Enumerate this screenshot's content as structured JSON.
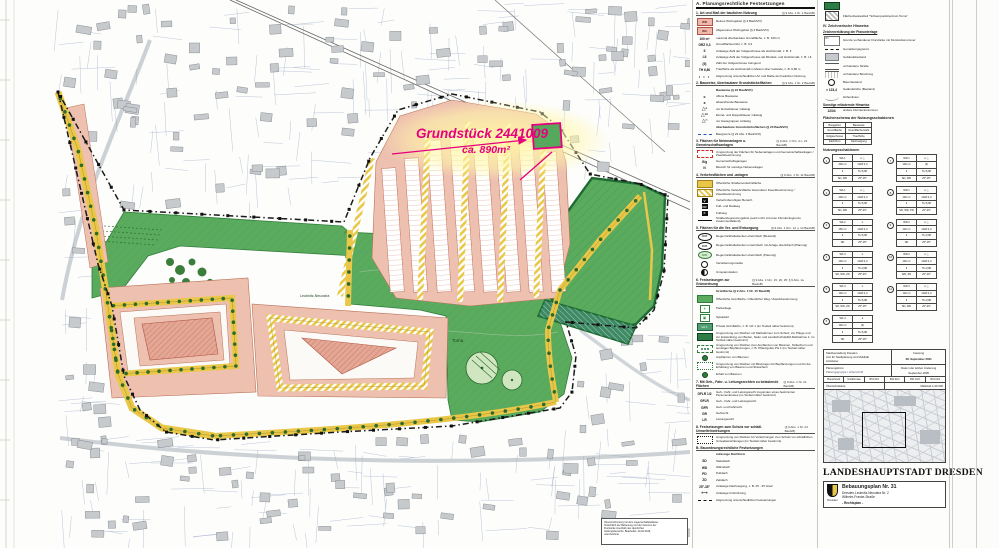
{
  "annotation": {
    "line1": "Grundstück 2441009",
    "line2": "ca. 890m²",
    "accent": "#e6007e"
  },
  "map_labels": {
    "green_area": "Torna",
    "green_band": "Leubnitz-Neuostra"
  },
  "note_lines": [
    "Übereinstimmung mit dem Liegenschaftskataster",
    "hinsichtlich der Bebauung und der Grenzen der",
    "Flurstücke innerhalb des räumlichen",
    "Geltungsbereichs. Bearbeitet: 20.04.2016,",
    "unterzeichnet"
  ],
  "colors": {
    "green": "#5aab5e",
    "pink": "#eec0b0",
    "yellow": "#e9c849",
    "magenta": "#e6007e",
    "dark_green": "#2f7d3a"
  },
  "legend1": {
    "header": "A. Planungsrechtliche Festsetzungen",
    "sections": [
      {
        "num": "1.",
        "title": "Art und Maß der baulichen Nutzung",
        "ref": "(§ 9 Abs. 1 Nr. 1 BauGB)",
        "items": [
          {
            "sym": "pink",
            "symtext": "WR",
            "label": "Reines Wohngebiet (§ 3 BauNVO)"
          },
          {
            "sym": "pink",
            "symtext": "WA",
            "label": "Allgemeines Wohngebiet (§ 4 BauNVO)"
          },
          {
            "sym": "text",
            "symtext": "100 m²",
            "label": "maximal überbaubare Grundfläche, z. B. 100 m²"
          },
          {
            "sym": "text",
            "symtext": "GRZ 0,3",
            "label": "Grundflächenzahl, z. B. 0,3"
          },
          {
            "sym": "text",
            "symtext": "II",
            "label": "zulässige Zahl der Vollgeschosse als Höchstmaß, z. B. II"
          },
          {
            "sym": "text",
            "symtext": "I-II",
            "label": "zulässige Zahl der Vollgeschosse als Mindest- und Höchstmaß, z. B. I-II"
          },
          {
            "sym": "text",
            "symtext": "(II)",
            "label": "Zahl der Vollgeschosse zwingend"
          },
          {
            "sym": "text",
            "symtext": "TH 6,80",
            "label": "Traufhöhe als Höchstmaß in Metern über Gelände, z. B. 6,80 m"
          },
          {
            "sym": "dots",
            "symtext": "",
            "label": "Abgrenzung unterschiedlicher Art und Maße der baulichen Nutzung"
          }
        ]
      },
      {
        "num": "2.",
        "title": "Bauweise, überbaubare Grundstücksflächen",
        "ref": "(§ 9 Abs. 1 Nr. 2 BauGB)",
        "items": [
          {
            "sym": "sub",
            "symtext": "",
            "label": "Bauweise (§ 22 BauNVO)"
          },
          {
            "sym": "text",
            "symtext": "o",
            "label": "offene Bauweise"
          },
          {
            "sym": "text",
            "symtext": "a",
            "label": "abweichende Bauweise"
          },
          {
            "sym": "tri",
            "symtext": "E",
            "label": "nur Einzelhäuser zulässig"
          },
          {
            "sym": "tri",
            "symtext": "ED",
            "label": "Einzel- und Doppelhäuser zulässig"
          },
          {
            "sym": "tri",
            "symtext": "H",
            "label": "nur Hausgruppen zulässig"
          },
          {
            "sym": "sub",
            "symtext": "",
            "label": "überbaubare Grundstücksflächen (§ 23 BauNVO)"
          },
          {
            "sym": "bluedash",
            "symtext": "",
            "label": "Baugrenze (§ 23 Abs. 3 BauNVO)"
          }
        ]
      },
      {
        "num": "3.",
        "title": "Flächen für Nebenanlagen u. Gemeinschaftsanlagen",
        "ref": "(§ 9 Abs. 1 Nrn. 4 u. 22 BauGB)",
        "items": [
          {
            "sym": "reddash",
            "symtext": "",
            "label": "Umgrenzung der Flächen für Nebenanlagen und Gemeinschaftsanlagen / Zweckbestimmung"
          },
          {
            "sym": "text",
            "symtext": "G/g",
            "label": "Gemeinschaftsgaragen"
          },
          {
            "sym": "text",
            "symtext": "N",
            "label": "Bereich für sonstige Nebenanlagen"
          }
        ]
      },
      {
        "num": "4.",
        "title": "Verkehrsflächen und -anlagen",
        "ref": "(§ 9 Abs. 1 Nr. 11 BauGB)",
        "items": [
          {
            "sym": "orange",
            "symtext": "",
            "label": "Öffentliche Straßenverkehrsfläche"
          },
          {
            "sym": "stripes",
            "symtext": "",
            "label": "Öffentliche Verkehrsfläche besonderer Zweckbestimmung / Zweckbestimmung"
          },
          {
            "sym": "badge",
            "symtext": "V",
            "label": "Verkehrsberuhigter Bereich"
          },
          {
            "sym": "badge",
            "symtext": "FR",
            "label": "Fuß- und Radweg"
          },
          {
            "sym": "badge",
            "symtext": "F",
            "label": "Fußweg"
          },
          {
            "sym": "line",
            "symtext": "",
            "label": "Straßenbegrenzungslinie (auch nicht mit einer Flurstücksgrenze zusammenfallend)"
          }
        ]
      },
      {
        "num": "5.",
        "title": "Flächen für die Ver- und Entsorgung",
        "ref": "(§ 9 Abs. 1 Nrn. 12 u. 14 BauGB)",
        "items": [
          {
            "sym": "oval",
            "symtext": "RRB",
            "label": "Regenrückhaltebecken oberirdisch (Bestand)"
          },
          {
            "sym": "oval",
            "symtext": "RRB",
            "label": "Regenrückhaltebecken unterirdisch mit Anlage oberirdisch (Planung)"
          },
          {
            "sym": "ovalg",
            "symtext": "RRB",
            "label": "Regenrückhaltebecken oberirdisch (Planung)"
          },
          {
            "sym": "circ2",
            "symtext": "",
            "label": "Versickerungsmulde"
          },
          {
            "sym": "circ",
            "symtext": "",
            "label": "Umspannstation"
          }
        ]
      },
      {
        "num": "6.",
        "title": "Festsetzungen zur Grünordnung",
        "ref": "(§ 9 Abs. 1 Nrn. 15, 20, 25; § 9 Abs. 1a BauGB)",
        "items": [
          {
            "sym": "sub",
            "symtext": "",
            "label": "Grünfläche (§ 9 Abs. 1 Nr. 15 BauGB)"
          },
          {
            "sym": "green",
            "symtext": "",
            "label": "Öffentliche Grünfläche / öffentlicher Weg / Zweckbestimmung"
          },
          {
            "sym": "park",
            "symtext": "⚘",
            "label": "Parkanlage"
          },
          {
            "sym": "park",
            "symtext": "▣",
            "label": "Spielplatz"
          },
          {
            "sym": "pgreen",
            "symtext": "GF 1",
            "label": "Private Grünfläche, z. B. GF 1 (im Textteil näher bestimmt)"
          },
          {
            "sym": "emgreen",
            "symtext": "",
            "label": "Umgrenzung von Flächen mit Maßnahmen zum Schutz, zur Pflege und zur Entwicklung von Boden, Natur und Landschaft (E&M-Maßnahme 1; im Textteil näher bestimmt)"
          },
          {
            "sym": "plantbox",
            "symtext": "",
            "label": "Umgrenzung von Flächen zum Anpflanzen von Bäumen, Sträuchern und sonstigen Bepflanzungen, z. B. Pflanzgebot PG 1 (im Textteil näher bestimmt)"
          },
          {
            "sym": "dot",
            "symtext": "",
            "label": "Anpflanzen von Bäumen"
          },
          {
            "sym": "bindbox",
            "symtext": "",
            "label": "Umgrenzung von Flächen mit Bindungen für Bepflanzungen und für die Erhaltung von Bäumen und Sträuchern"
          },
          {
            "sym": "dot",
            "symtext": "",
            "label": "Erhalt von Bäumen"
          }
        ]
      },
      {
        "num": "7.",
        "title": "Mit Geh-, Fahr- u. Leitungsrechten zu belastende Flächen",
        "ref": "(§ 9 Abs. 1 Nr. 21 BauGB)",
        "items": [
          {
            "sym": "text",
            "symtext": "GFLR 1/2",
            "label": "Geh-, Fahr- und Leitungsrecht zugunsten eines bestimmten Personenkreises (im Textteil näher bestimmt)"
          },
          {
            "sym": "text",
            "symtext": "GFLR",
            "label": "Geh-, Fahr- und Leitungsrecht"
          },
          {
            "sym": "text",
            "symtext": "GFR",
            "label": "Geh- und Fahrrecht"
          },
          {
            "sym": "text",
            "symtext": "GR",
            "label": "Gehrecht"
          },
          {
            "sym": "text",
            "symtext": "LR",
            "label": "Leitungsrecht"
          }
        ]
      },
      {
        "num": "8.",
        "title": "Festsetzungen zum Schutz vor schädl. Umwelteinwirkungen",
        "ref": "(§ 9 Abs. 1 Nr. 24 BauGB)",
        "items": [
          {
            "sym": "envbox",
            "symtext": "",
            "label": "Umgrenzung von Flächen für Vorkehrungen zum Schutz vor schädlichen Umwelteinwirkungen (im Textteil näher bestimmt)"
          }
        ]
      },
      {
        "num": "B.",
        "title": "Bauordnungsrechtliche Festsetzungen",
        "ref": "",
        "items": [
          {
            "sym": "sub",
            "symtext": "",
            "label": "zulässige Dachform"
          },
          {
            "sym": "text",
            "symtext": "SD",
            "label": "Satteldach"
          },
          {
            "sym": "text",
            "symtext": "WD",
            "label": "Walmdach"
          },
          {
            "sym": "text",
            "symtext": "PD",
            "label": "Pultdach"
          },
          {
            "sym": "text",
            "symtext": "ZD",
            "label": "Zeltdach"
          },
          {
            "sym": "text",
            "symtext": "25°-35°",
            "label": "zulässige Dachneigung, z. B. 25 - 35 Grad"
          },
          {
            "sym": "first",
            "symtext": "⟷",
            "label": "zulässige Firstrichtung"
          },
          {
            "sym": "dashdot",
            "symtext": "",
            "label": "Abgrenzung unterschiedlicher Festsetzungen"
          }
        ]
      }
    ]
  },
  "legend2": {
    "top_items": [
      {
        "sym": "emgreen",
        "label": ""
      },
      {
        "sym": "hatchbox",
        "label": "Flächenbestandteil \"Schwerpunktzentrum Torna\""
      }
    ],
    "hinweise_title": "IV. Zeichnerische Hinweise",
    "hinweise_sub": "Zeichenerklärung der Planunterlage",
    "hinweise_items": [
      {
        "sym": "parcel",
        "label": "Grenze vorhandener Flurstücke mit Flurstücksnummer"
      },
      {
        "sym": "dashdot",
        "label": "Gemarkungsgrenze"
      },
      {
        "sym": "graybox",
        "label": "Gebäudebestand"
      },
      {
        "sym": "road2",
        "label": "vorhandene Straße"
      },
      {
        "sym": "slope",
        "label": "vorhandene Böschung"
      },
      {
        "sym": "circ2",
        "label": "Baumbestand"
      },
      {
        "sym": "text",
        "symtext": "× 123,4",
        "label": "Geländehöhe (Bestand)"
      },
      {
        "sym": "contour",
        "label": "Höhenlinien"
      }
    ],
    "hinweise_sub2": "Sonstige erläuternde Hinweise",
    "hinweise_items2": [
      {
        "sym": "text",
        "symtext": "123/4",
        "label": "andere Flurstücksnummer"
      }
    ],
    "schema_title": "Flächenschema der Nutzungsschablonen",
    "schema_rows": [
      [
        "Baugebiet",
        "Bauweise"
      ],
      [
        "Grundfläche",
        "Grundflächenzahl"
      ],
      [
        "Vollgeschosse",
        "Traufhöhe"
      ],
      [
        "Dachform",
        "Dachneigung"
      ]
    ],
    "nz_title": "Nutzungsschablonen",
    "schablonen": [
      {
        "n": "1",
        "rows": [
          [
            "WA 1",
            "o △"
          ],
          [
            "200 m²",
            "GRZ 0,3"
          ],
          [
            "II",
            "TH 6,80"
          ],
          [
            "SD, WD",
            "25°-35°"
          ]
        ]
      },
      {
        "n": "2",
        "rows": [
          [
            "WA 1",
            "o △"
          ],
          [
            "200 m²",
            "GRZ 0,3"
          ],
          [
            "II",
            "TH 6,80"
          ],
          [
            "SD, WD",
            "25°-45°"
          ]
        ]
      },
      {
        "n": "3",
        "rows": [
          [
            "WA 2",
            "o"
          ],
          [
            "150 m²",
            "GRZ 0,3"
          ],
          [
            "II",
            "TH 6,80"
          ],
          [
            "SD",
            "25°-35°"
          ]
        ]
      },
      {
        "n": "4",
        "rows": [
          [
            "WA 3",
            "o"
          ],
          [
            "130 m²",
            "GRZ 0,3"
          ],
          [
            "II",
            "TH 3,80"
          ],
          [
            "SD, WD, ZD",
            "25°-45°"
          ]
        ]
      },
      {
        "n": "5",
        "rows": [
          [
            "WA 3",
            "o"
          ],
          [
            "130 m²",
            "GRZ 0,3"
          ],
          [
            "II",
            "TH 6,80"
          ],
          [
            "SD, WD, ZD",
            "25°-35°"
          ]
        ]
      },
      {
        "n": "6",
        "rows": [
          [
            "WA 4",
            "a"
          ],
          [
            "130 m²",
            "(II)"
          ],
          [
            "II",
            "TH 6,80"
          ],
          [
            "SD",
            "25°-35°"
          ]
        ]
      },
      {
        "n": "7",
        "rows": [
          [
            "WR 1",
            "o △"
          ],
          [
            "100 m²",
            "(II)"
          ],
          [
            "II",
            "TH 6,80"
          ],
          [
            "SD, WD",
            "25°-35°"
          ]
        ]
      },
      {
        "n": "8",
        "rows": [
          [
            "WR 1",
            "o △"
          ],
          [
            "130 m²",
            "GRZ 0,3"
          ],
          [
            "II",
            "TH 6,80"
          ],
          [
            "SD, WD, PD",
            "20°-45°"
          ]
        ]
      },
      {
        "n": "9",
        "rows": [
          [
            "WR 2",
            "o △"
          ],
          [
            "120 m²",
            "GRZ 0,3"
          ],
          [
            "II",
            "TH 3,80"
          ],
          [
            "SD",
            "25°-35°"
          ]
        ]
      },
      {
        "n": "10",
        "rows": [
          [
            "WR 2",
            "o △"
          ],
          [
            "130 m²",
            "GRZ 0,3"
          ],
          [
            "II",
            "TH 3,80"
          ],
          [
            "WD, ZD",
            "20°-30°"
          ]
        ]
      },
      {
        "n": "11",
        "rows": [
          [
            "WR 3",
            "o △"
          ],
          [
            "120 m²",
            "GRZ 0,3"
          ],
          [
            "II",
            "TH 3,80"
          ],
          [
            "SD, WD",
            "20°-45°"
          ]
        ]
      }
    ],
    "stamp": {
      "office1": "Stadtverwaltung Dresden",
      "office2": "Amt für Stadtplanung und Mobilität",
      "office3": "Amtsleiter",
      "fassung_label": "Fassung",
      "fassung_date": "28. September 2021",
      "buero_label": "Planungsbüro:",
      "buero_sig": "Planungsgruppe / Unterschrift",
      "change_label": "Datum der letzten Änderung",
      "change_date": "September 2005",
      "cells": [
        "Planschrank",
        "Großformate",
        "B31 61/1",
        "B31 61/2",
        "B31 61/3",
        "B31 61/4"
      ],
      "ov_label": "Übersichtskarte",
      "ov_scale": "Maßstab 1:20 000"
    },
    "city_title": "LANDESHAUPTSTADT DRESDEN",
    "titleblock": {
      "title": "Bebauungsplan Nr. 31",
      "line1": "Dresden-Leubnitz-Neuostra Nr. 2",
      "line2": "Wilhelm-Franke-Straße",
      "line3": "- Rechtsplan -",
      "crest": "Dresden"
    }
  }
}
